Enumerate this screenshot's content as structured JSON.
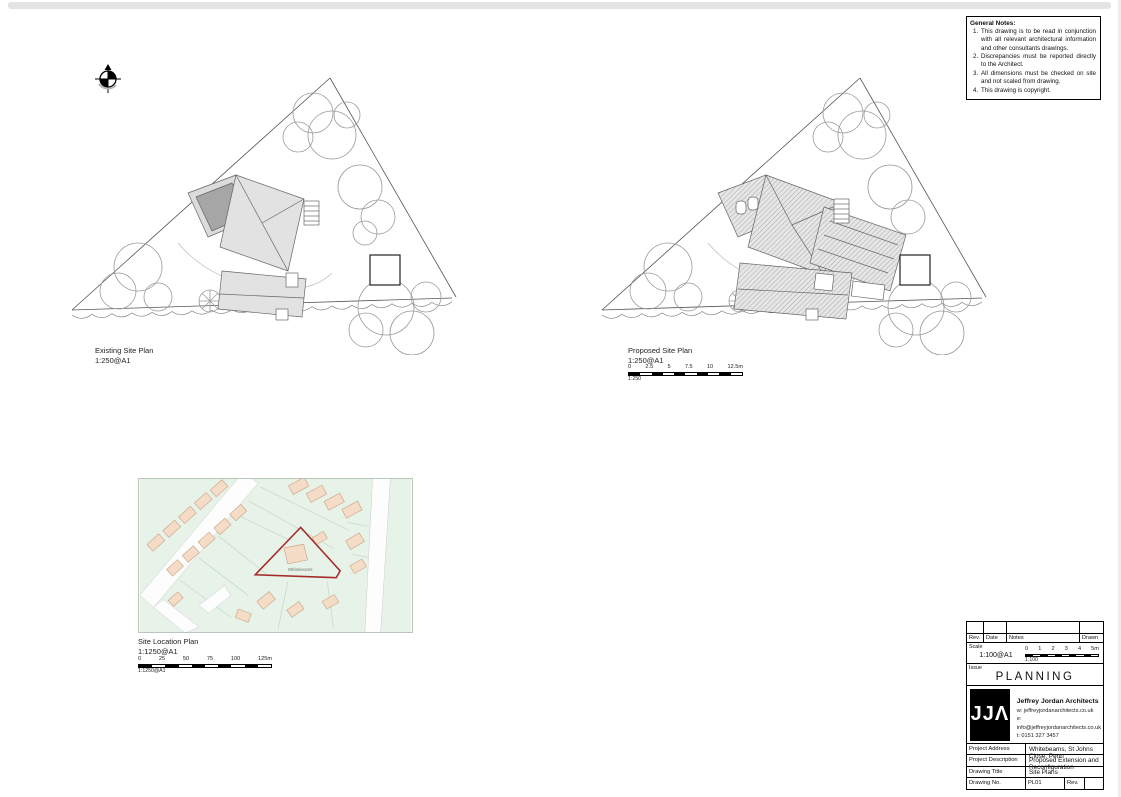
{
  "notes": {
    "title": "General Notes:",
    "items": [
      {
        "num": "1.",
        "text": "This drawing is to be read in conjunction with all relevant architectural information and other consultants drawings."
      },
      {
        "num": "2.",
        "text": "Discrepancies must be reported directly to the Architect."
      },
      {
        "num": "3.",
        "text": "All dimensions must be checked on site and not scaled from drawing."
      },
      {
        "num": "4.",
        "text": "This drawing is copyright."
      }
    ]
  },
  "plans": {
    "existing": {
      "title": "Existing Site Plan",
      "scale": "1:250@A1"
    },
    "proposed": {
      "title": "Proposed Site Plan",
      "scale": "1:250@A1",
      "scalebar": {
        "ticks": [
          "0",
          "2.5",
          "5",
          "7.5",
          "10",
          "12.5m"
        ],
        "ratio": "1:250"
      }
    },
    "location": {
      "title": "Site Location Plan",
      "scale": "1:1250@A1",
      "site_label": "Whitebeams",
      "scalebar": {
        "ticks": [
          "0",
          "25",
          "50",
          "75",
          "100",
          "125m"
        ],
        "ratio": "1:1250@A1"
      }
    }
  },
  "title_block": {
    "rev_header": {
      "rev": "Rev.",
      "date": "Date",
      "notes": "Notes",
      "drawn": "Drawn"
    },
    "scale_label": "Scale",
    "scale_value": "1:100@A1",
    "scalebar": {
      "ticks": [
        "0",
        "1",
        "2",
        "3",
        "4",
        "5m"
      ],
      "ratio": "1:100"
    },
    "issue_label": "Issue",
    "issue_value": "PLANNING",
    "logo_text": "JJΛ",
    "firm": {
      "name": "Jeffrey Jordan Architects",
      "web": "w: jeffreyjordanarchitects.co.uk",
      "email": "e: info@jeffreyjordanarchitects.co.uk",
      "phone": "t: 0151 327 3457"
    },
    "rows": [
      {
        "label": "Project Address",
        "value": "Whitebeams, St Johns Close, Penn"
      },
      {
        "label": "Project Description",
        "value": "Proposed Extension and Reconfiguration"
      },
      {
        "label": "Drawing Title",
        "value": "Site Plans"
      },
      {
        "label": "Drawing No.",
        "value": "PL01",
        "rev_label": "Rev."
      }
    ]
  }
}
